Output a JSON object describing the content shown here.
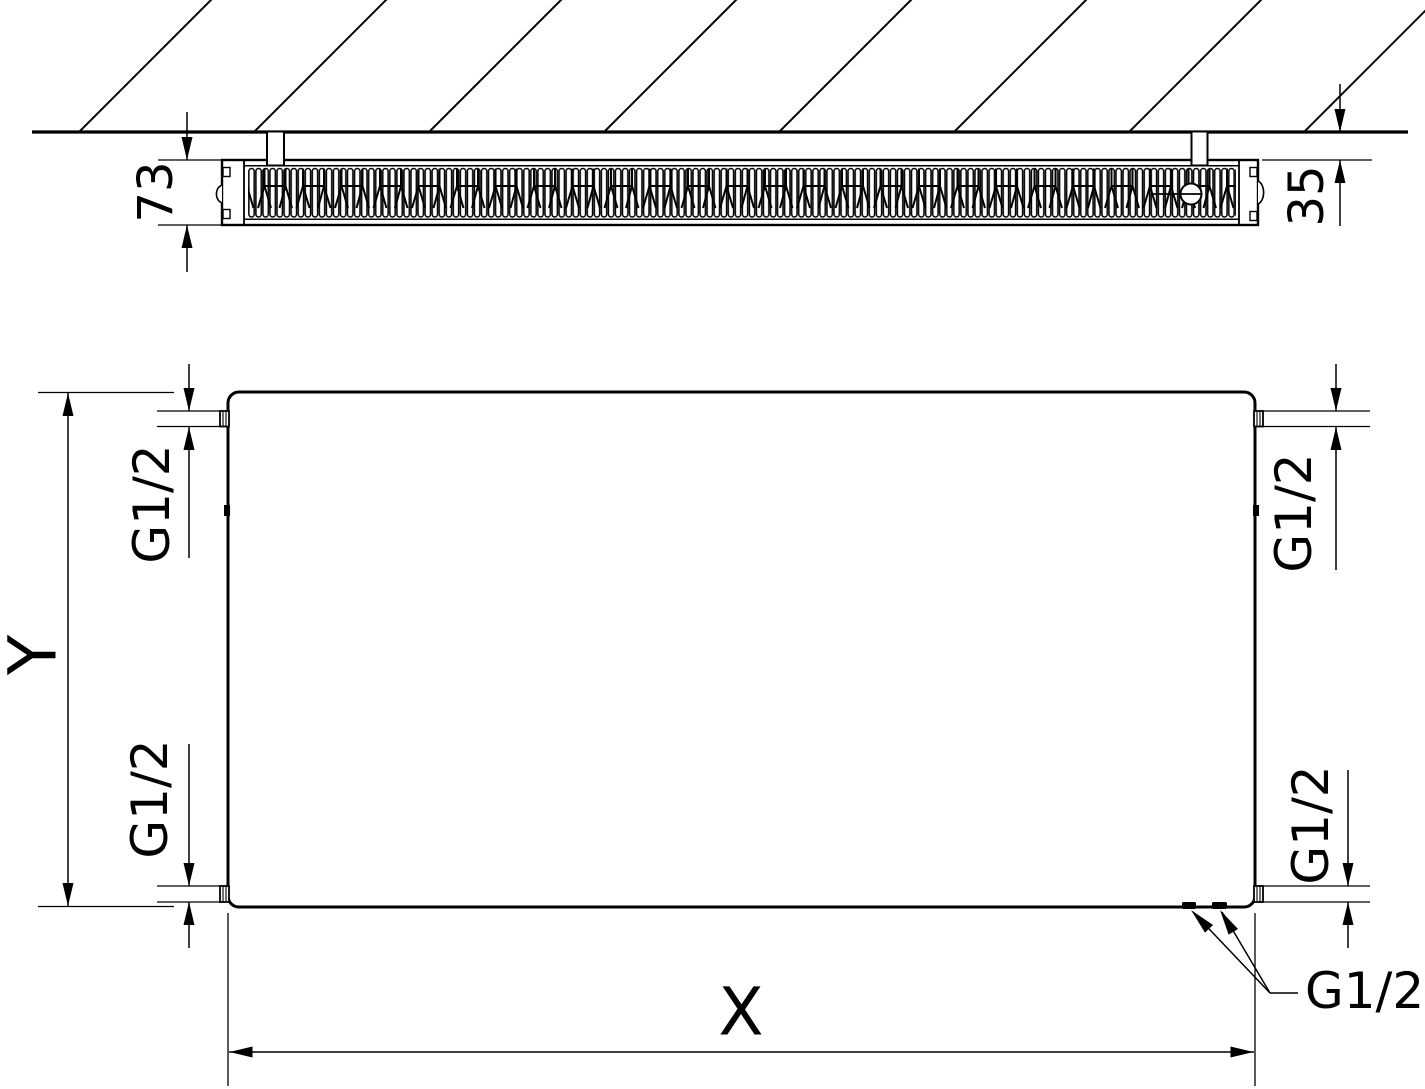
{
  "page": {
    "background": "#ffffff",
    "line_color": "#000000",
    "description": "Technical dimension drawing of a wall-mounted flat panel radiator: top section view against hatched wall, and front view with thread connections"
  },
  "top_view": {
    "depth_dim": "73",
    "wall_distance_dim": "35"
  },
  "front_view": {
    "height_dim": "Y",
    "width_dim": "X",
    "conn_top_left": "G1/2",
    "conn_bottom_left": "G1/2",
    "conn_top_right": "G1/2",
    "conn_bottom_right": "G1/2",
    "conn_bottom_label": "G1/2"
  }
}
